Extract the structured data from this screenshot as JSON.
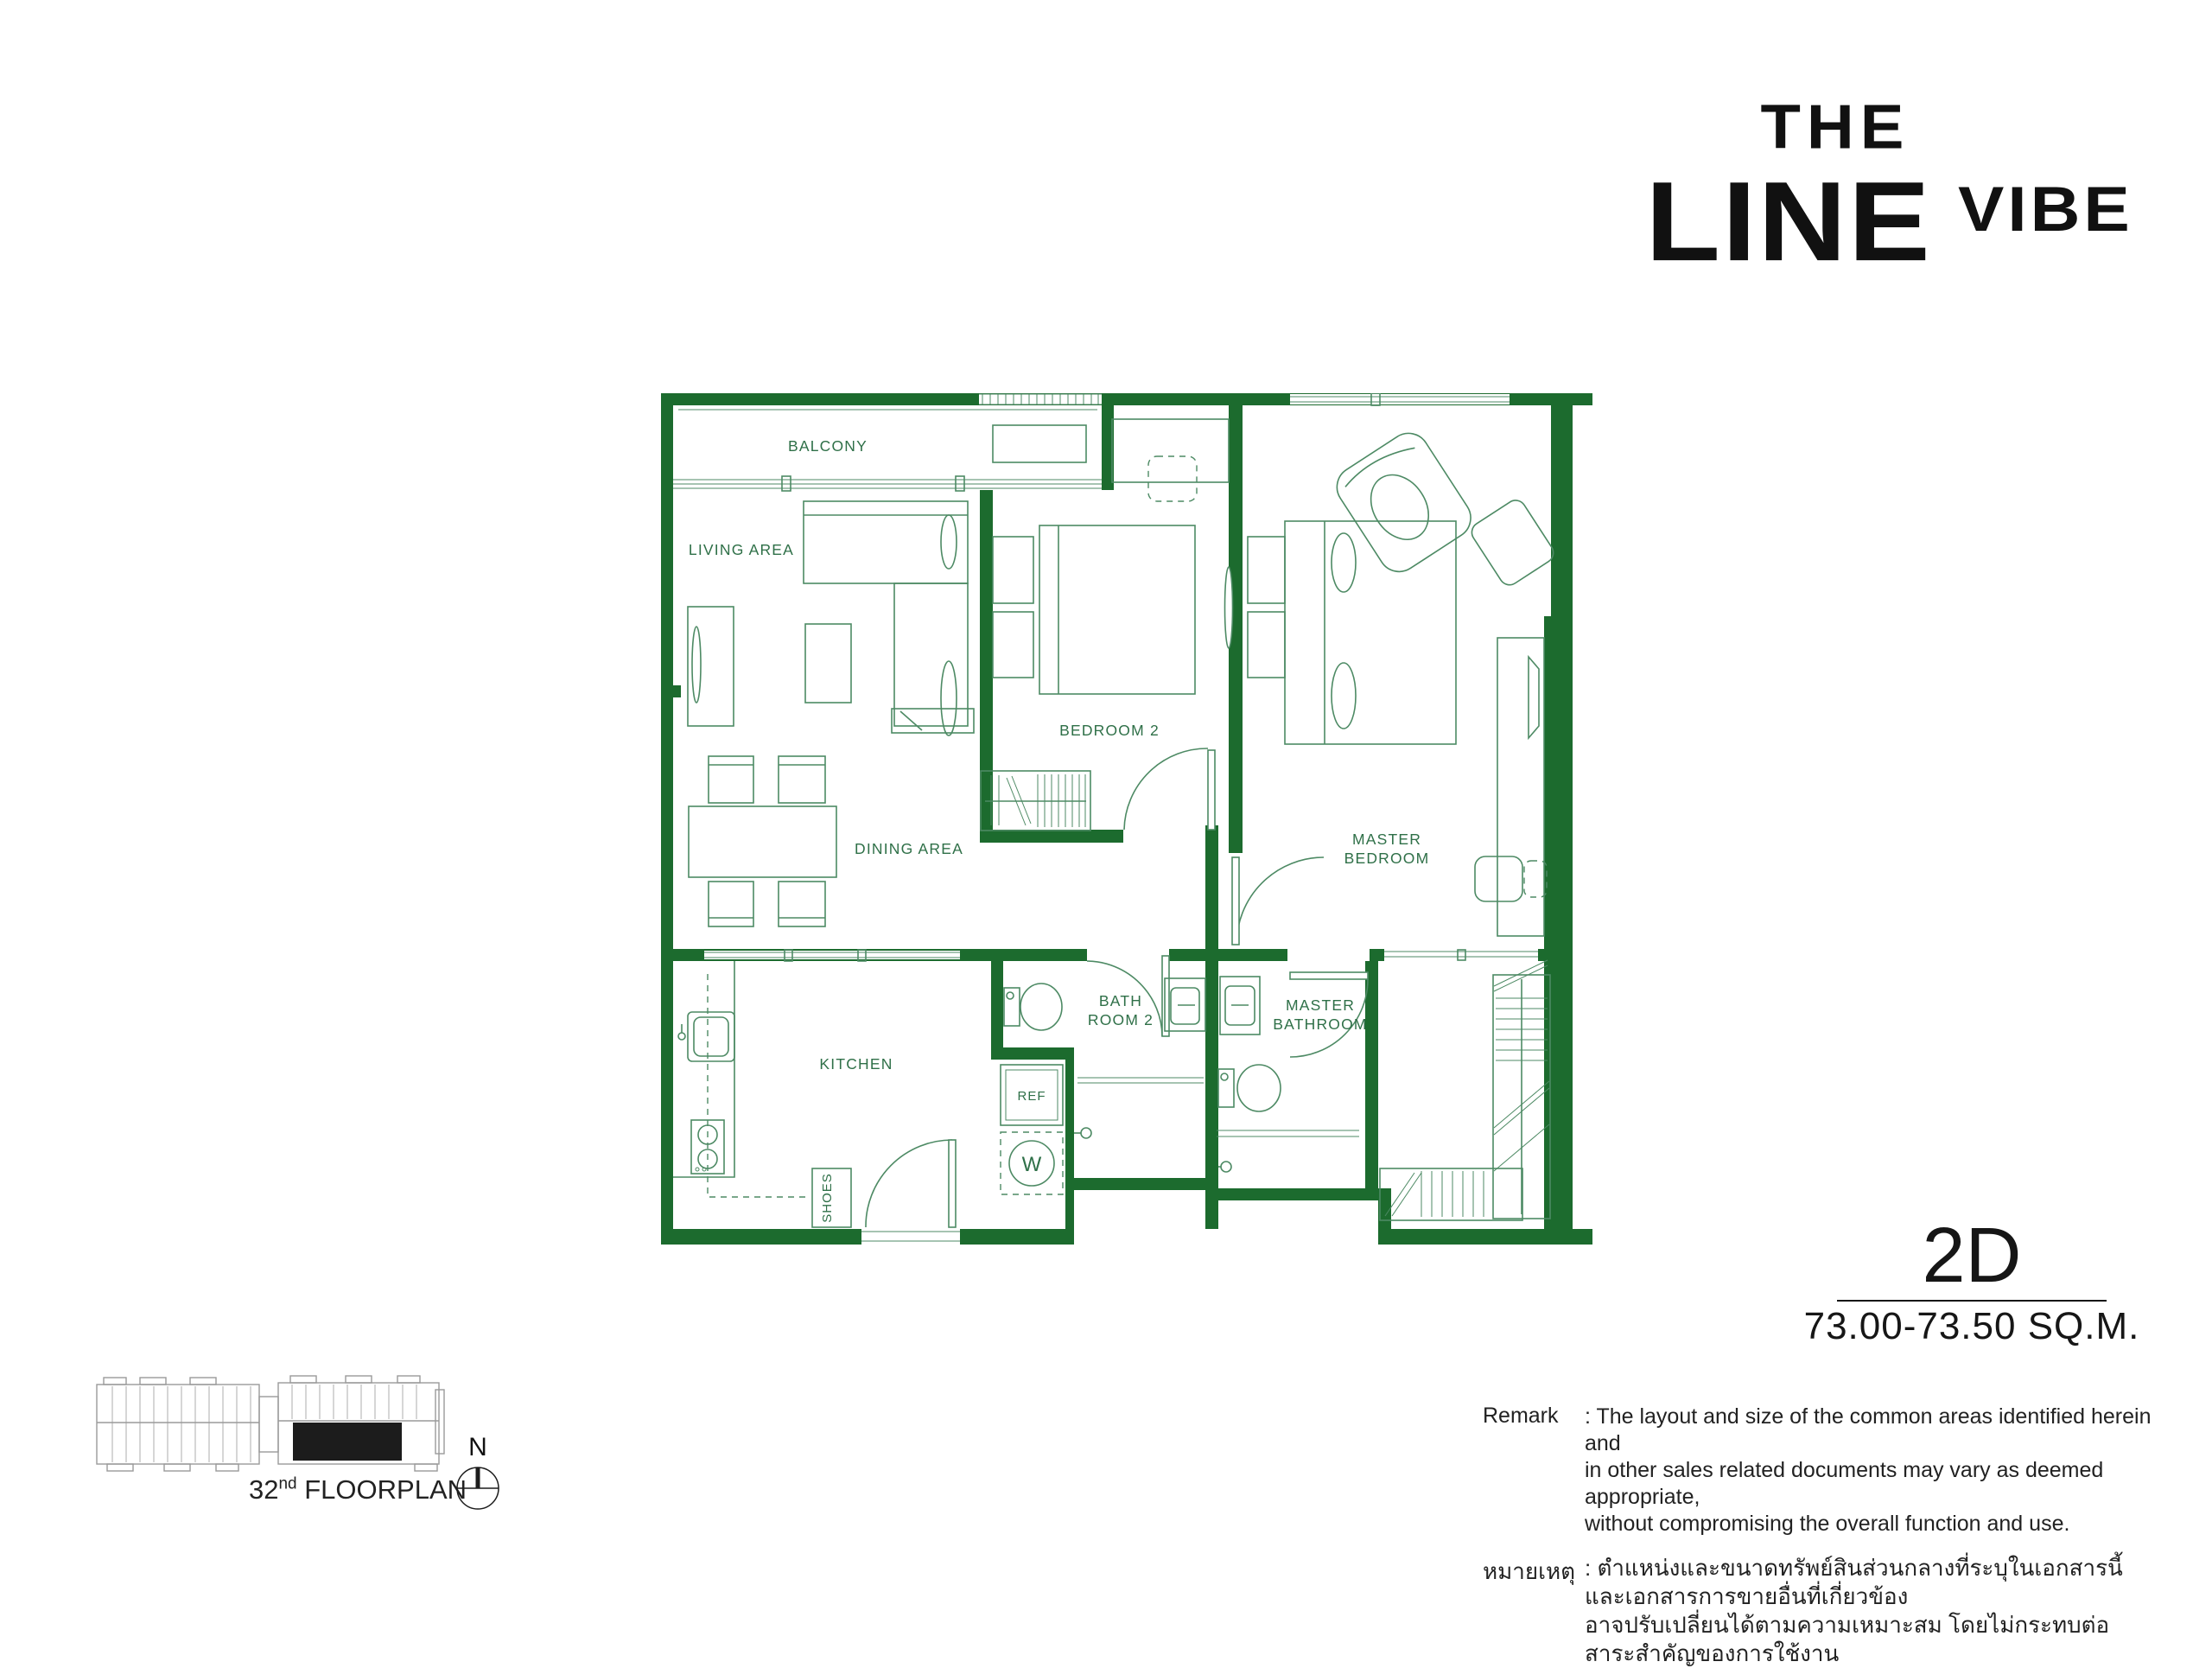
{
  "logo": {
    "the": "THE",
    "line": "LINE",
    "vibe": "VIBE"
  },
  "unit": {
    "code": "2D",
    "area": "73.00-73.50 SQ.M."
  },
  "plan": {
    "rooms": {
      "balcony": "BALCONY",
      "living": "LIVING AREA",
      "dining": "DINING AREA",
      "bedroom2": "BEDROOM 2",
      "master_bedroom_1": "MASTER",
      "master_bedroom_2": "BEDROOM",
      "kitchen": "KITCHEN",
      "bath2_1": "BATH",
      "bath2_2": "ROOM 2",
      "master_bath_1": "MASTER",
      "master_bath_2": "BATHROOM",
      "ref": "REF",
      "washer": "W",
      "shoes": "SHOES"
    },
    "colors": {
      "wall": "#1c6b2e",
      "furniture_line": "#4d8a64",
      "label": "#2f7048"
    }
  },
  "remark": {
    "label": "Remark",
    "lines": [
      ": The layout and size of the common areas identified herein and",
      "in other sales related documents may vary as deemed appropriate,",
      "without compromising the overall function and use."
    ],
    "thai_label": "หมายเหตุ",
    "thai_lines": [
      ": ตำแหน่งและขนาดทรัพย์สินส่วนกลางที่ระบุในเอกสารนี้และเอกสารการขายอื่นที่เกี่ยวข้อง",
      "อาจปรับเปลี่ยนได้ตามความเหมาะสม โดยไม่กระทบต่อสาระสำคัญของการใช้งาน"
    ]
  },
  "locator": {
    "floor_number": "32",
    "floor_suffix": "nd",
    "caption": " FLOORPLAN",
    "compass": "N"
  }
}
